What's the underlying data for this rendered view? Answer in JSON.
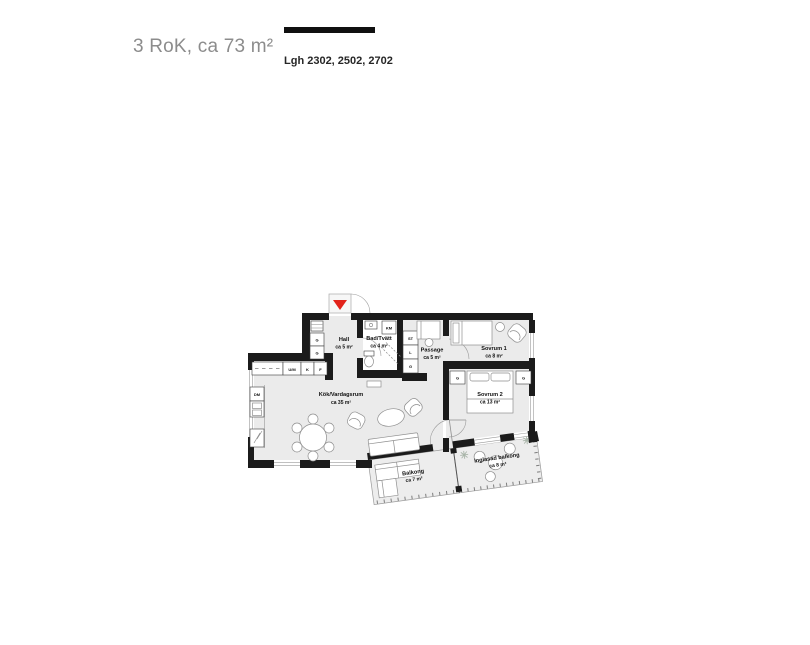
{
  "header": {
    "title": "3 RoK, ca 73 m²",
    "apartments": "Lgh 2302, 2502, 2702"
  },
  "colors": {
    "wall": "#1b1b1b",
    "floor": "#ebebeb",
    "accent_red": "#e2231a",
    "furniture_line": "#8f8f8f",
    "title_gray": "#8c8c8c"
  },
  "plan": {
    "rooms": {
      "hall": {
        "name": "Hall",
        "area": "ca 5 m²"
      },
      "bath": {
        "name": "Bad/Tvätt",
        "area": "ca 4 m²"
      },
      "passage": {
        "name": "Passage",
        "area": "ca 5 m²"
      },
      "bedroom1": {
        "name": "Sovrum 1",
        "area": "ca 8 m²"
      },
      "bedroom2": {
        "name": "Sovrum 2",
        "area": "ca 13 m²"
      },
      "living": {
        "name": "Kök/Vardagsrum",
        "area": "ca 35 m²"
      },
      "balcony": {
        "name": "Balkong",
        "area": "ca 7 m²"
      },
      "glazed_balcony": {
        "name": "Inglasad balkong",
        "area": "ca 8 m²"
      }
    },
    "fixtures": {
      "wardrobe": "G",
      "washing_machine": "KM",
      "cleaning_closet": "ST",
      "linen_closet": "L",
      "micro_oven": "U/M",
      "fridge": "K",
      "freezer": "F",
      "dishwasher": "DM"
    }
  }
}
